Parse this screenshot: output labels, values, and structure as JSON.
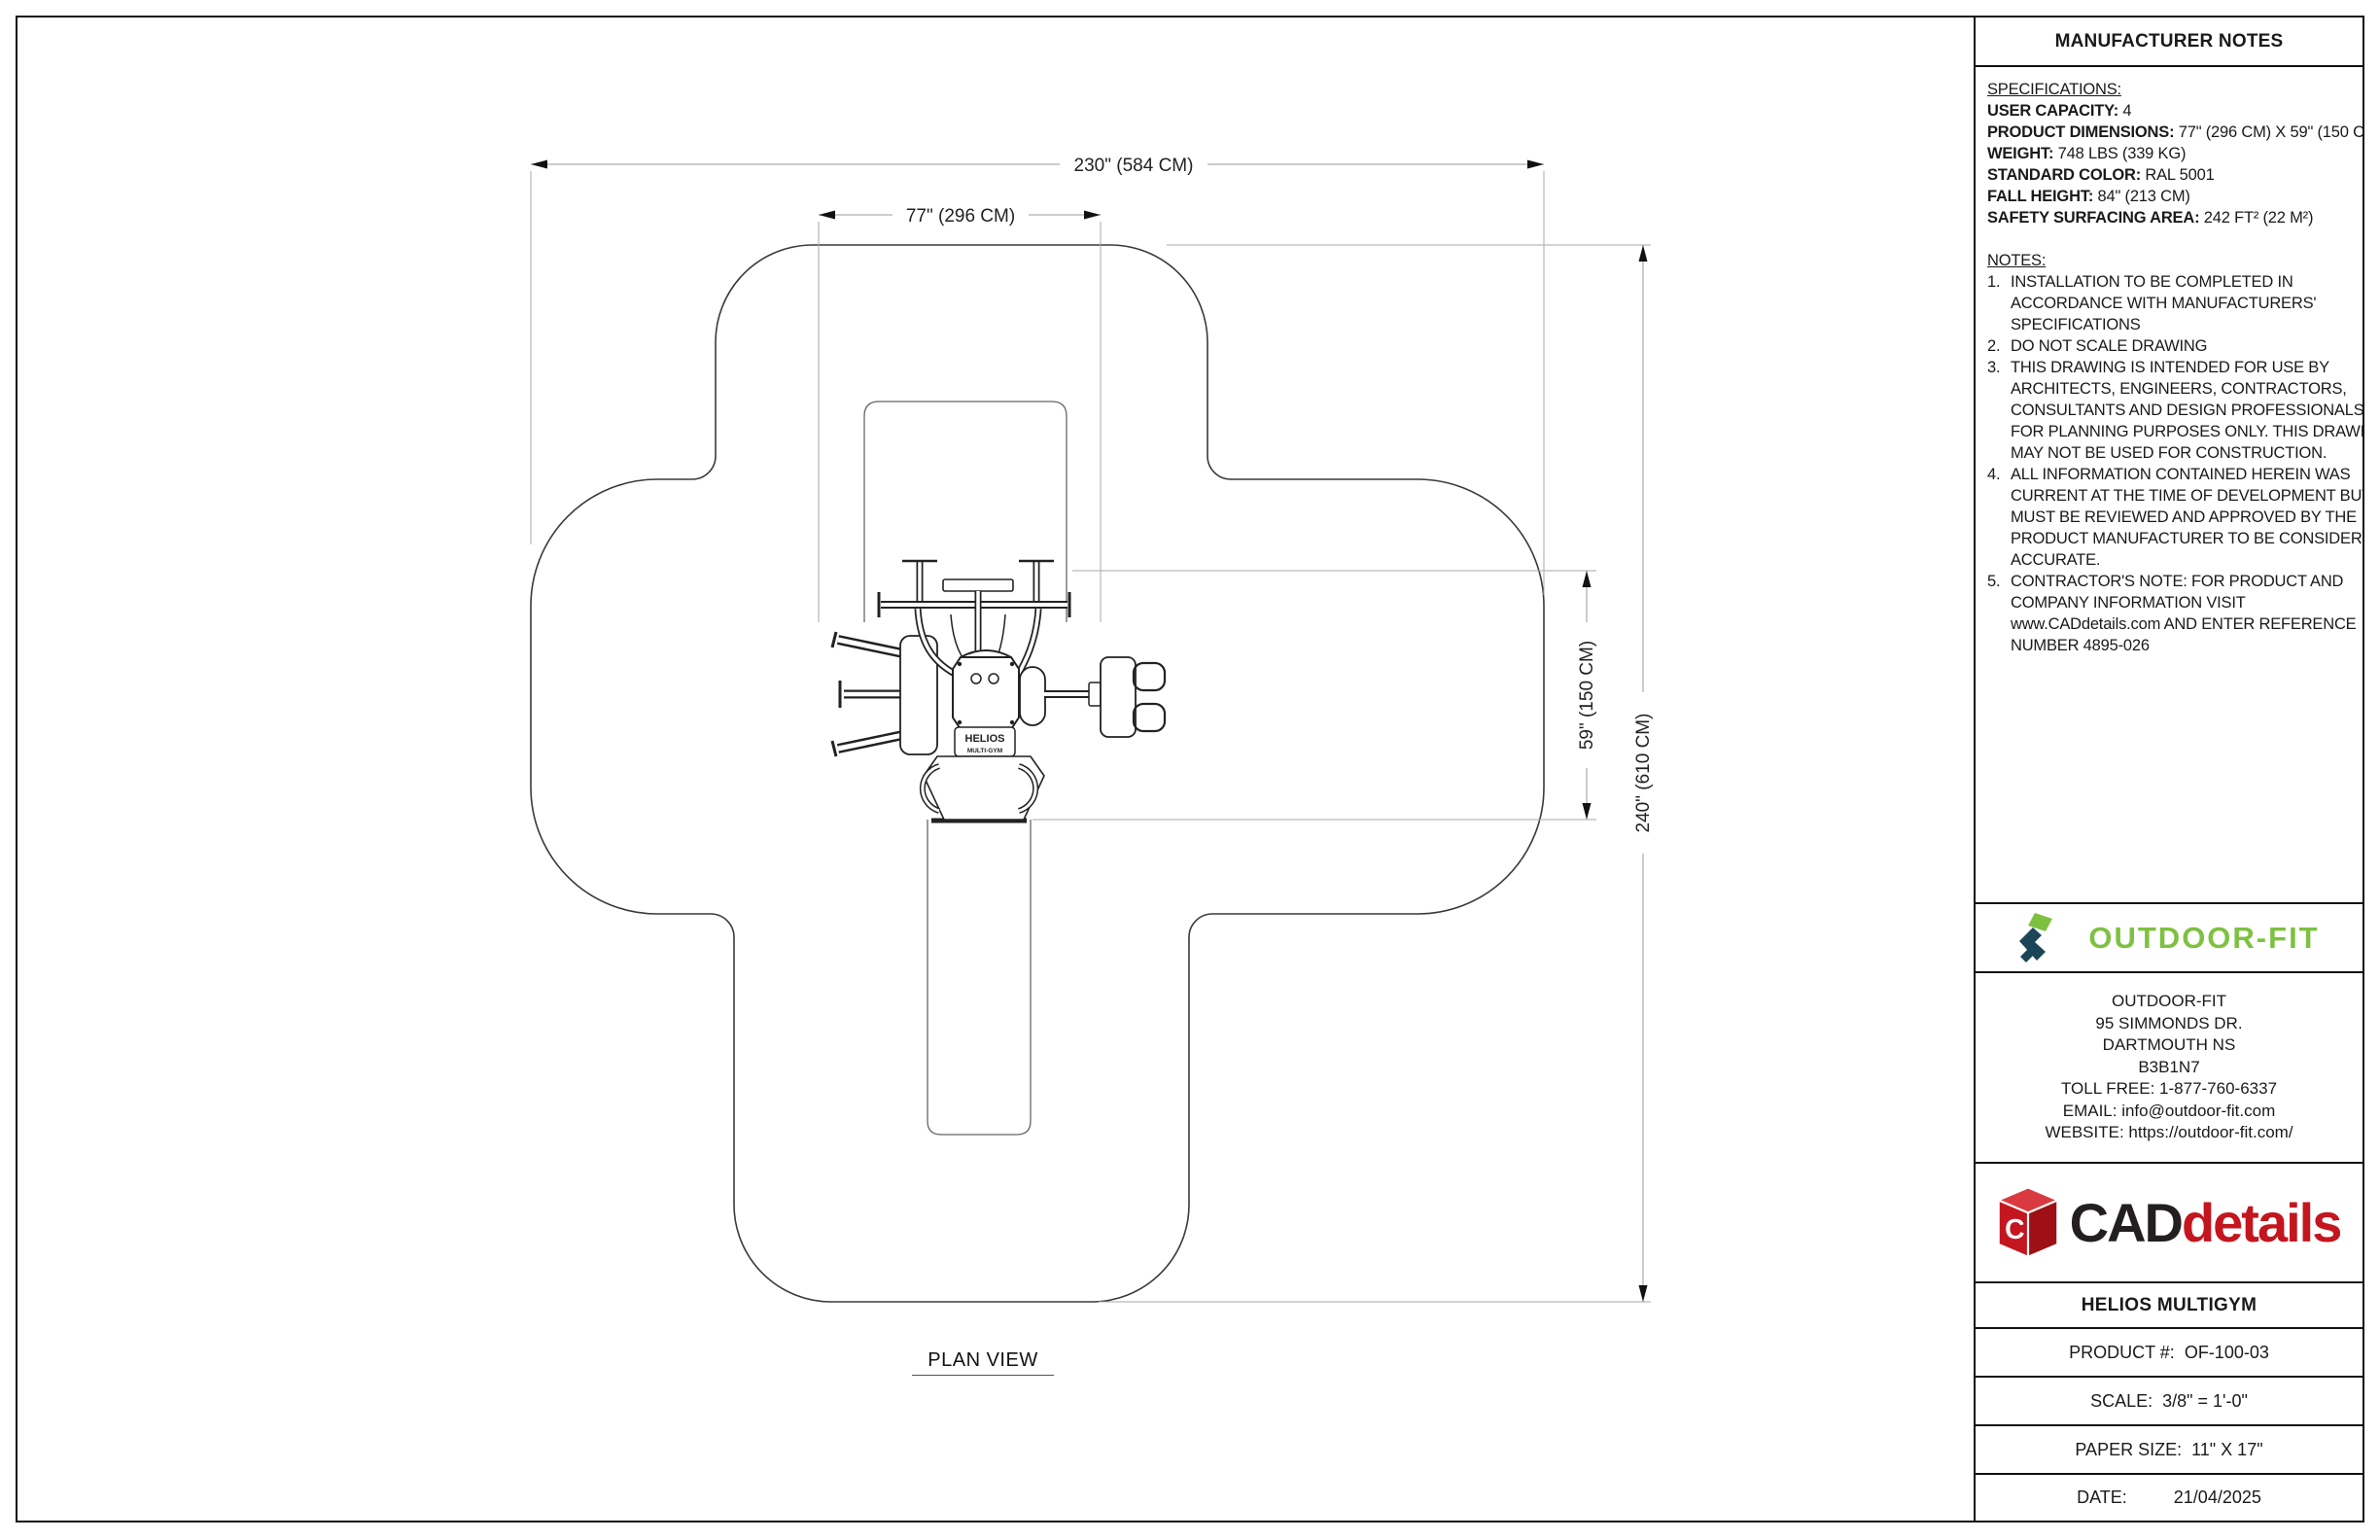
{
  "drawing": {
    "plan_view_label": "PLAN VIEW",
    "equipment_label_line1": "HELIOS",
    "equipment_label_line2": "MULTI-GYM",
    "dimensions": {
      "overall_width": "230\" (584 CM)",
      "product_width": "77\" (296 CM)",
      "overall_height": "240\" (610 CM)",
      "product_depth": "59\" (150 CM)"
    }
  },
  "panel": {
    "header": "MANUFACTURER NOTES",
    "specifications": {
      "heading": "SPECIFICATIONS:",
      "items": [
        {
          "label": "USER CAPACITY:",
          "value": "4"
        },
        {
          "label": "PRODUCT DIMENSIONS:",
          "value": "77\" (296 CM) X 59\" (150 CM)"
        },
        {
          "label": "WEIGHT:",
          "value": "748 LBS (339 KG)"
        },
        {
          "label": "STANDARD COLOR:",
          "value": "RAL 5001"
        },
        {
          "label": "FALL HEIGHT:",
          "value": "84\" (213 CM)"
        },
        {
          "label": "SAFETY SURFACING AREA:",
          "value": "242 FT² (22 M²)"
        }
      ]
    },
    "notes": {
      "heading": "NOTES:",
      "items": [
        {
          "num": "1.",
          "lines": [
            "INSTALLATION TO BE COMPLETED IN",
            "ACCORDANCE WITH MANUFACTURERS'",
            "SPECIFICATIONS"
          ]
        },
        {
          "num": "2.",
          "lines": [
            "DO NOT SCALE DRAWING"
          ]
        },
        {
          "num": "3.",
          "lines": [
            "THIS DRAWING IS INTENDED FOR USE BY",
            "ARCHITECTS, ENGINEERS, CONTRACTORS,",
            "CONSULTANTS AND DESIGN PROFESSIONALS",
            "FOR PLANNING PURPOSES ONLY. THIS DRAWING",
            "MAY NOT BE USED FOR CONSTRUCTION."
          ]
        },
        {
          "num": "4.",
          "lines": [
            "ALL INFORMATION CONTAINED HEREIN WAS",
            "CURRENT AT THE TIME OF DEVELOPMENT BUT",
            "MUST BE REVIEWED AND APPROVED BY THE",
            "PRODUCT MANUFACTURER TO BE CONSIDERED",
            "ACCURATE."
          ]
        },
        {
          "num": "5.",
          "lines": [
            "CONTRACTOR'S NOTE: FOR PRODUCT AND",
            "COMPANY INFORMATION VISIT",
            "www.CADdetails.com AND ENTER REFERENCE",
            "NUMBER 4895-026"
          ]
        }
      ]
    },
    "manufacturer": {
      "logo_text": "OUTDOOR-FIT",
      "address_lines": [
        "OUTDOOR-FIT",
        "95 SIMMONDS DR.",
        "DARTMOUTH NS",
        "B3B1N7",
        "TOLL FREE: 1-877-760-6337",
        "EMAIL: info@outdoor-fit.com",
        "WEBSITE: https://outdoor-fit.com/"
      ]
    },
    "caddetails": {
      "logo_cad": "CAD",
      "logo_details": "details"
    },
    "title_block": {
      "product_title": "HELIOS MULTIGYM",
      "rows": [
        {
          "label": "PRODUCT #:",
          "value": "OF-100-03"
        },
        {
          "label": "SCALE:",
          "value": "3/8\" = 1'-0\""
        },
        {
          "label": "PAPER SIZE:",
          "value": "11\" X 17\""
        },
        {
          "label": "DATE:",
          "value": "21/04/2025"
        }
      ]
    }
  },
  "colors": {
    "brand_green": "#7EC141",
    "brand_navy": "#1C4657",
    "cad_red": "#C4161F",
    "line_dark": "#222222",
    "line_gray": "#aaaaaa"
  }
}
